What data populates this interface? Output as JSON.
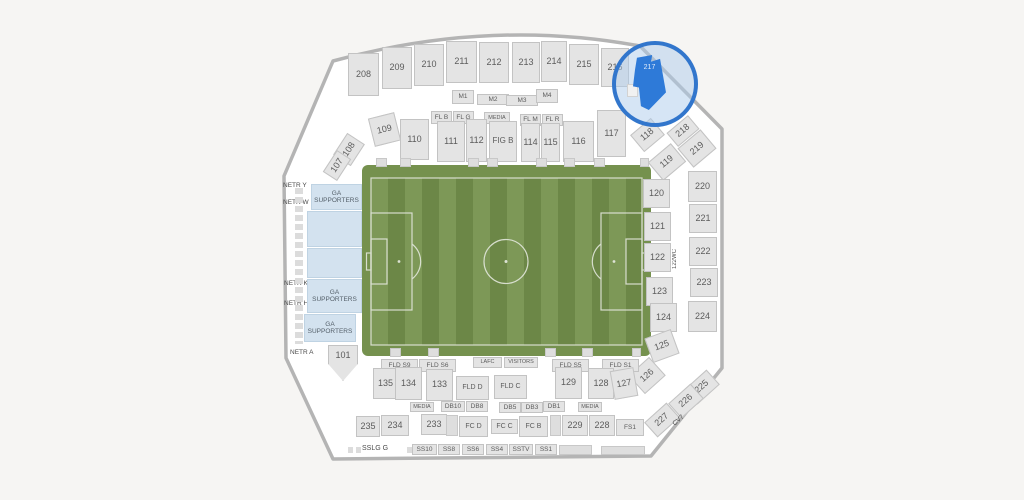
{
  "app": {
    "view": "stadium-seating-map",
    "highlighted_section": "217",
    "colors": {
      "background": "#f6f5f3",
      "bowl_wall_gray": "#b4b4b4",
      "section_fill": "#e4e4e4",
      "section_border": "#c3c3c3",
      "ga_fill": "#d3e2ef",
      "field_band_green": "#75914e",
      "field_stripe_light": "#7d9857",
      "field_stripe_dark": "#6c8747",
      "field_line_white": "#e9ece4",
      "highlight_blue": "#2e7ad8",
      "lens_border_blue": "#3276cc"
    }
  },
  "map": {
    "sections": [
      {
        "l": "208",
        "x": 348,
        "y": 53,
        "w": 31,
        "h": 43,
        "t": "std"
      },
      {
        "l": "209",
        "x": 382,
        "y": 47,
        "w": 30,
        "h": 42,
        "t": "std"
      },
      {
        "l": "210",
        "x": 414,
        "y": 44,
        "w": 30,
        "h": 42,
        "t": "std"
      },
      {
        "l": "211",
        "x": 446,
        "y": 41,
        "w": 31,
        "h": 42,
        "t": "std"
      },
      {
        "l": "212",
        "x": 479,
        "y": 42,
        "w": 30,
        "h": 41,
        "t": "std"
      },
      {
        "l": "213",
        "x": 512,
        "y": 42,
        "w": 28,
        "h": 41,
        "t": "std"
      },
      {
        "l": "214",
        "x": 541,
        "y": 41,
        "w": 26,
        "h": 41,
        "t": "std"
      },
      {
        "l": "215",
        "x": 569,
        "y": 44,
        "w": 30,
        "h": 41,
        "t": "std"
      },
      {
        "l": "216",
        "x": 601,
        "y": 48,
        "w": 28,
        "h": 39,
        "t": "std"
      },
      {
        "l": "217",
        "x": 633,
        "y": 55,
        "w": 33,
        "h": 55,
        "t": "hl",
        "c": "flag",
        "n": "section-217-highlighted"
      },
      {
        "l": "",
        "x": 627,
        "y": 84,
        "w": 11,
        "h": 13,
        "t": "decolight",
        "z": 21
      },
      {
        "l": "M1",
        "x": 452,
        "y": 90,
        "w": 22,
        "h": 14,
        "t": "sm"
      },
      {
        "l": "M2",
        "x": 477,
        "y": 94,
        "w": 32,
        "h": 11,
        "t": "sm"
      },
      {
        "l": "M3",
        "x": 506,
        "y": 95,
        "w": 32,
        "h": 11,
        "t": "sm"
      },
      {
        "l": "M4",
        "x": 536,
        "y": 89,
        "w": 22,
        "h": 14,
        "t": "sm"
      },
      {
        "l": "FL B",
        "x": 431,
        "y": 111,
        "w": 21,
        "h": 13,
        "t": "sm"
      },
      {
        "l": "FL G",
        "x": 453,
        "y": 111,
        "w": 21,
        "h": 13,
        "t": "sm"
      },
      {
        "l": "MEDIA",
        "x": 484,
        "y": 112,
        "w": 26,
        "h": 12,
        "t": "sm",
        "fs": 5.5
      },
      {
        "l": "FL M",
        "x": 520,
        "y": 114,
        "w": 21,
        "h": 12,
        "t": "sm"
      },
      {
        "l": "FL R",
        "x": 542,
        "y": 114,
        "w": 21,
        "h": 12,
        "t": "sm"
      },
      {
        "l": "109",
        "x": 371,
        "y": 115,
        "w": 27,
        "h": 29,
        "t": "std",
        "r": -14
      },
      {
        "l": "110",
        "x": 400,
        "y": 119,
        "w": 29,
        "h": 41,
        "t": "std"
      },
      {
        "l": "111",
        "x": 437,
        "y": 121,
        "w": 28,
        "h": 41,
        "t": "std"
      },
      {
        "l": "112",
        "x": 466,
        "y": 119,
        "w": 21,
        "h": 43,
        "t": "std"
      },
      {
        "l": "FIG B",
        "x": 489,
        "y": 121,
        "w": 28,
        "h": 41,
        "t": "std",
        "fs": 8
      },
      {
        "l": "114",
        "x": 521,
        "y": 123,
        "w": 19,
        "h": 39,
        "t": "std"
      },
      {
        "l": "115",
        "x": 541,
        "y": 123,
        "w": 19,
        "h": 39,
        "t": "std"
      },
      {
        "l": "116",
        "x": 563,
        "y": 121,
        "w": 31,
        "h": 41,
        "t": "std"
      },
      {
        "l": "117",
        "x": 597,
        "y": 110,
        "w": 29,
        "h": 47,
        "t": "std"
      },
      {
        "l": "118",
        "x": 634,
        "y": 124,
        "w": 27,
        "h": 22,
        "t": "std",
        "r": -40
      },
      {
        "l": "108",
        "x": 336,
        "y": 139,
        "w": 26,
        "h": 21,
        "t": "std",
        "r": -57
      },
      {
        "l": "107",
        "x": 324,
        "y": 157,
        "w": 26,
        "h": 17,
        "t": "std",
        "r": -57
      },
      {
        "l": "NETR Y",
        "x": 283,
        "y": 181,
        "w": 30,
        "h": 9,
        "t": "text"
      },
      {
        "l": "NETR W",
        "x": 283,
        "y": 198,
        "w": 30,
        "h": 9,
        "t": "text"
      },
      {
        "l": "NETR K",
        "x": 284,
        "y": 279,
        "w": 30,
        "h": 9,
        "t": "text"
      },
      {
        "l": "NETR H",
        "x": 284,
        "y": 299,
        "w": 30,
        "h": 9,
        "t": "text"
      },
      {
        "l": "NETR A",
        "x": 290,
        "y": 348,
        "w": 30,
        "h": 9,
        "t": "text"
      },
      {
        "l": "",
        "x": 295,
        "y": 188,
        "w": 8,
        "h": 156,
        "t": "sqv",
        "n": "suite-boxes-strip"
      },
      {
        "l": "105WC",
        "x": 308,
        "y": 213,
        "w": 12,
        "h": 36,
        "t": "vtext"
      },
      {
        "l": "104WC",
        "x": 306,
        "y": 249,
        "w": 12,
        "h": 34,
        "t": "vtext"
      },
      {
        "l": "GA\nSUPPORTERS",
        "x": 311,
        "y": 184,
        "w": 51,
        "h": 26,
        "t": "ga",
        "n": "section-ga-supporters"
      },
      {
        "l": "",
        "x": 307,
        "y": 211,
        "w": 55,
        "h": 36,
        "t": "ga",
        "n": "section-ga-supporters"
      },
      {
        "l": "",
        "x": 307,
        "y": 248,
        "w": 55,
        "h": 30,
        "t": "ga",
        "n": "section-ga-supporters"
      },
      {
        "l": "GA\nSUPPORTERS",
        "x": 307,
        "y": 279,
        "w": 55,
        "h": 34,
        "t": "ga",
        "n": "section-ga-supporters"
      },
      {
        "l": "GA\nSUPPORTERS",
        "x": 304,
        "y": 314,
        "w": 52,
        "h": 28,
        "t": "ga",
        "n": "section-ga-supporters"
      },
      {
        "l": "101",
        "x": 328,
        "y": 345,
        "w": 30,
        "h": 36,
        "t": "std",
        "c": "down"
      },
      {
        "l": "119",
        "x": 652,
        "y": 150,
        "w": 30,
        "h": 24,
        "t": "std",
        "r": -40
      },
      {
        "l": "120",
        "x": 643,
        "y": 179,
        "w": 27,
        "h": 29,
        "t": "std"
      },
      {
        "l": "121",
        "x": 644,
        "y": 212,
        "w": 27,
        "h": 29,
        "t": "std"
      },
      {
        "l": "122",
        "x": 644,
        "y": 243,
        "w": 27,
        "h": 29,
        "t": "std"
      },
      {
        "l": "123",
        "x": 646,
        "y": 277,
        "w": 27,
        "h": 29,
        "t": "std"
      },
      {
        "l": "124",
        "x": 650,
        "y": 303,
        "w": 27,
        "h": 29,
        "t": "std"
      },
      {
        "l": "125",
        "x": 648,
        "y": 333,
        "w": 28,
        "h": 26,
        "t": "std",
        "r": -20
      },
      {
        "l": "126",
        "x": 633,
        "y": 363,
        "w": 28,
        "h": 25,
        "t": "std",
        "r": -42
      },
      {
        "l": "122WC",
        "x": 670,
        "y": 242,
        "w": 11,
        "h": 33,
        "t": "vtext"
      },
      {
        "l": "218",
        "x": 669,
        "y": 122,
        "w": 28,
        "h": 18,
        "t": "std",
        "r": -40
      },
      {
        "l": "219",
        "x": 682,
        "y": 136,
        "w": 30,
        "h": 25,
        "t": "std",
        "r": -40
      },
      {
        "l": "220",
        "x": 688,
        "y": 171,
        "w": 29,
        "h": 31,
        "t": "std"
      },
      {
        "l": "221",
        "x": 689,
        "y": 204,
        "w": 28,
        "h": 29,
        "t": "std"
      },
      {
        "l": "222",
        "x": 689,
        "y": 237,
        "w": 28,
        "h": 29,
        "t": "std"
      },
      {
        "l": "223",
        "x": 690,
        "y": 268,
        "w": 28,
        "h": 29,
        "t": "std"
      },
      {
        "l": "224",
        "x": 688,
        "y": 301,
        "w": 29,
        "h": 31,
        "t": "std"
      },
      {
        "l": "225",
        "x": 687,
        "y": 377,
        "w": 30,
        "h": 20,
        "t": "std",
        "r": -42
      },
      {
        "l": "226",
        "x": 671,
        "y": 391,
        "w": 30,
        "h": 20,
        "t": "std",
        "r": -42
      },
      {
        "l": "227",
        "x": 647,
        "y": 410,
        "w": 30,
        "h": 20,
        "t": "std",
        "r": -42
      },
      {
        "l": "CV7",
        "x": 671,
        "y": 413,
        "w": 24,
        "h": 8,
        "t": "text",
        "r": -42
      },
      {
        "l": "FLD S9",
        "x": 381,
        "y": 359,
        "w": 37,
        "h": 13,
        "t": "sm"
      },
      {
        "l": "FLD S6",
        "x": 419,
        "y": 359,
        "w": 37,
        "h": 13,
        "t": "sm"
      },
      {
        "l": "LAFC",
        "x": 473,
        "y": 357,
        "w": 29,
        "h": 11,
        "t": "sm",
        "fs": 5.5
      },
      {
        "l": "VISITORS",
        "x": 504,
        "y": 357,
        "w": 34,
        "h": 11,
        "t": "sm",
        "fs": 5.5
      },
      {
        "l": "FLD S5",
        "x": 552,
        "y": 359,
        "w": 37,
        "h": 13,
        "t": "sm"
      },
      {
        "l": "FLD S1",
        "x": 602,
        "y": 359,
        "w": 37,
        "h": 13,
        "t": "sm"
      },
      {
        "l": "135",
        "x": 373,
        "y": 368,
        "w": 25,
        "h": 31,
        "t": "std"
      },
      {
        "l": "134",
        "x": 395,
        "y": 367,
        "w": 27,
        "h": 33,
        "t": "std"
      },
      {
        "l": "133",
        "x": 426,
        "y": 369,
        "w": 27,
        "h": 32,
        "t": "std"
      },
      {
        "l": "FLD D",
        "x": 456,
        "y": 376,
        "w": 33,
        "h": 24,
        "t": "sm",
        "fs": 7
      },
      {
        "l": "FLD C",
        "x": 494,
        "y": 375,
        "w": 33,
        "h": 24,
        "t": "sm",
        "fs": 7
      },
      {
        "l": "129",
        "x": 555,
        "y": 367,
        "w": 27,
        "h": 32,
        "t": "std"
      },
      {
        "l": "128",
        "x": 588,
        "y": 368,
        "w": 26,
        "h": 31,
        "t": "std"
      },
      {
        "l": "127",
        "x": 612,
        "y": 369,
        "w": 24,
        "h": 29,
        "t": "std",
        "r": -10
      },
      {
        "l": "MEDIA",
        "x": 410,
        "y": 402,
        "w": 24,
        "h": 10,
        "t": "sm",
        "fs": 5.5
      },
      {
        "l": "DB10",
        "x": 441,
        "y": 401,
        "w": 24,
        "h": 11,
        "t": "sm"
      },
      {
        "l": "DB8",
        "x": 466,
        "y": 401,
        "w": 22,
        "h": 11,
        "t": "sm"
      },
      {
        "l": "DB5",
        "x": 499,
        "y": 402,
        "w": 22,
        "h": 11,
        "t": "sm"
      },
      {
        "l": "DB3",
        "x": 521,
        "y": 402,
        "w": 22,
        "h": 11,
        "t": "sm"
      },
      {
        "l": "DB1",
        "x": 543,
        "y": 401,
        "w": 22,
        "h": 11,
        "t": "sm"
      },
      {
        "l": "MEDIA",
        "x": 578,
        "y": 402,
        "w": 24,
        "h": 10,
        "t": "sm",
        "fs": 5.5
      },
      {
        "l": "235",
        "x": 356,
        "y": 416,
        "w": 24,
        "h": 21,
        "t": "std"
      },
      {
        "l": "234",
        "x": 381,
        "y": 415,
        "w": 28,
        "h": 21,
        "t": "std"
      },
      {
        "l": "233",
        "x": 421,
        "y": 414,
        "w": 26,
        "h": 21,
        "t": "std"
      },
      {
        "l": "",
        "x": 446,
        "y": 415,
        "w": 12,
        "h": 21,
        "t": "deco"
      },
      {
        "l": "FC D",
        "x": 459,
        "y": 416,
        "w": 29,
        "h": 21,
        "t": "sm",
        "fs": 7
      },
      {
        "l": "FC C",
        "x": 491,
        "y": 419,
        "w": 27,
        "h": 15,
        "t": "sm",
        "fs": 7
      },
      {
        "l": "FC B",
        "x": 519,
        "y": 416,
        "w": 29,
        "h": 21,
        "t": "sm",
        "fs": 7
      },
      {
        "l": "",
        "x": 550,
        "y": 415,
        "w": 11,
        "h": 21,
        "t": "deco"
      },
      {
        "l": "229",
        "x": 562,
        "y": 415,
        "w": 26,
        "h": 21,
        "t": "std"
      },
      {
        "l": "228",
        "x": 589,
        "y": 415,
        "w": 26,
        "h": 21,
        "t": "std"
      },
      {
        "l": "FS1",
        "x": 616,
        "y": 419,
        "w": 28,
        "h": 17,
        "t": "sm"
      },
      {
        "l": "",
        "x": 348,
        "y": 447,
        "w": 13,
        "h": 6,
        "t": "sqh"
      },
      {
        "l": "SSLG G",
        "x": 362,
        "y": 444,
        "w": 44,
        "h": 10,
        "t": "text",
        "fs": 7
      },
      {
        "l": "",
        "x": 407,
        "y": 447,
        "w": 8,
        "h": 6,
        "t": "sqh"
      },
      {
        "l": "SS10",
        "x": 412,
        "y": 444,
        "w": 25,
        "h": 11,
        "t": "sm"
      },
      {
        "l": "SS8",
        "x": 438,
        "y": 444,
        "w": 22,
        "h": 11,
        "t": "sm"
      },
      {
        "l": "SS6",
        "x": 462,
        "y": 444,
        "w": 22,
        "h": 11,
        "t": "sm"
      },
      {
        "l": "SS4",
        "x": 486,
        "y": 444,
        "w": 22,
        "h": 11,
        "t": "sm"
      },
      {
        "l": "SSTV",
        "x": 509,
        "y": 444,
        "w": 24,
        "h": 11,
        "t": "sm"
      },
      {
        "l": "SS1",
        "x": 535,
        "y": 444,
        "w": 22,
        "h": 11,
        "t": "sm"
      },
      {
        "l": "",
        "x": 559,
        "y": 445,
        "w": 33,
        "h": 10,
        "t": "deco"
      },
      {
        "l": "",
        "x": 601,
        "y": 446,
        "w": 44,
        "h": 9,
        "t": "deco"
      },
      {
        "l": "",
        "x": 376,
        "y": 158,
        "w": 11,
        "h": 9,
        "t": "deco"
      },
      {
        "l": "",
        "x": 400,
        "y": 158,
        "w": 11,
        "h": 9,
        "t": "deco"
      },
      {
        "l": "",
        "x": 468,
        "y": 158,
        "w": 11,
        "h": 9,
        "t": "deco"
      },
      {
        "l": "",
        "x": 487,
        "y": 158,
        "w": 11,
        "h": 9,
        "t": "deco"
      },
      {
        "l": "",
        "x": 536,
        "y": 158,
        "w": 11,
        "h": 9,
        "t": "deco"
      },
      {
        "l": "",
        "x": 564,
        "y": 158,
        "w": 11,
        "h": 9,
        "t": "deco"
      },
      {
        "l": "",
        "x": 594,
        "y": 158,
        "w": 11,
        "h": 9,
        "t": "deco"
      },
      {
        "l": "",
        "x": 640,
        "y": 158,
        "w": 9,
        "h": 9,
        "t": "deco"
      },
      {
        "l": "",
        "x": 390,
        "y": 348,
        "w": 11,
        "h": 9,
        "t": "deco"
      },
      {
        "l": "",
        "x": 428,
        "y": 348,
        "w": 11,
        "h": 9,
        "t": "deco"
      },
      {
        "l": "",
        "x": 545,
        "y": 348,
        "w": 11,
        "h": 9,
        "t": "deco"
      },
      {
        "l": "",
        "x": 582,
        "y": 348,
        "w": 11,
        "h": 9,
        "t": "deco"
      },
      {
        "l": "",
        "x": 632,
        "y": 348,
        "w": 9,
        "h": 9,
        "t": "deco"
      }
    ]
  }
}
